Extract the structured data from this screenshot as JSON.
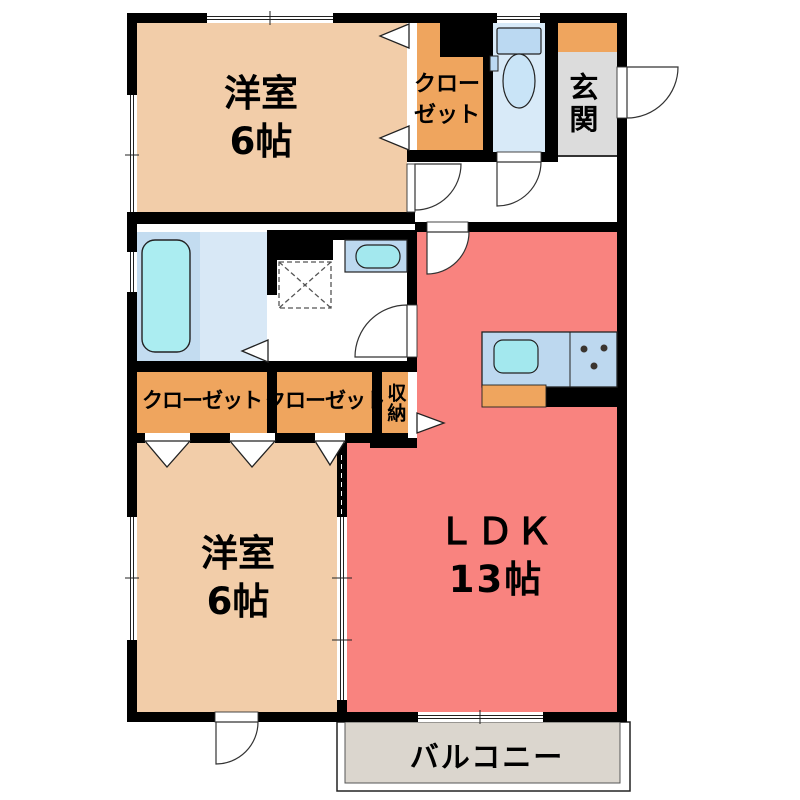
{
  "title": "2LDK apartment floor plan",
  "labels": {
    "bedroom_top": {
      "name": "洋室",
      "size": "6帖"
    },
    "bedroom_bottom": {
      "name": "洋室",
      "size": "6帖"
    },
    "ldk": {
      "name": "ＬＤＫ",
      "size": "13帖"
    },
    "closet_top": {
      "line1": "クロー",
      "line2": "ゼット"
    },
    "closet_left": "クローゼット",
    "closet_right": "クローゼット",
    "storage": "収納",
    "entrance": "玄関",
    "balcony": "バルコニー"
  },
  "palette": {
    "wall": "#000000",
    "bedroom_floor": "#F2CDA9",
    "closet_floor": "#EFA55E",
    "ldk_floor": "#F9837F",
    "bath_floor": "#C3DCF0",
    "bath_floor_light": "#D8E8F6",
    "toilet_floor": "#D8EAF8",
    "entrance_floor": "#DCDCDC",
    "balcony_floor": "#DBD6CE",
    "kitchen_counter": "#BDD8EF",
    "sink": "#A3E8EE",
    "bathtub": "#ABEDF1",
    "fixture_blue": "#BBD9F2"
  }
}
